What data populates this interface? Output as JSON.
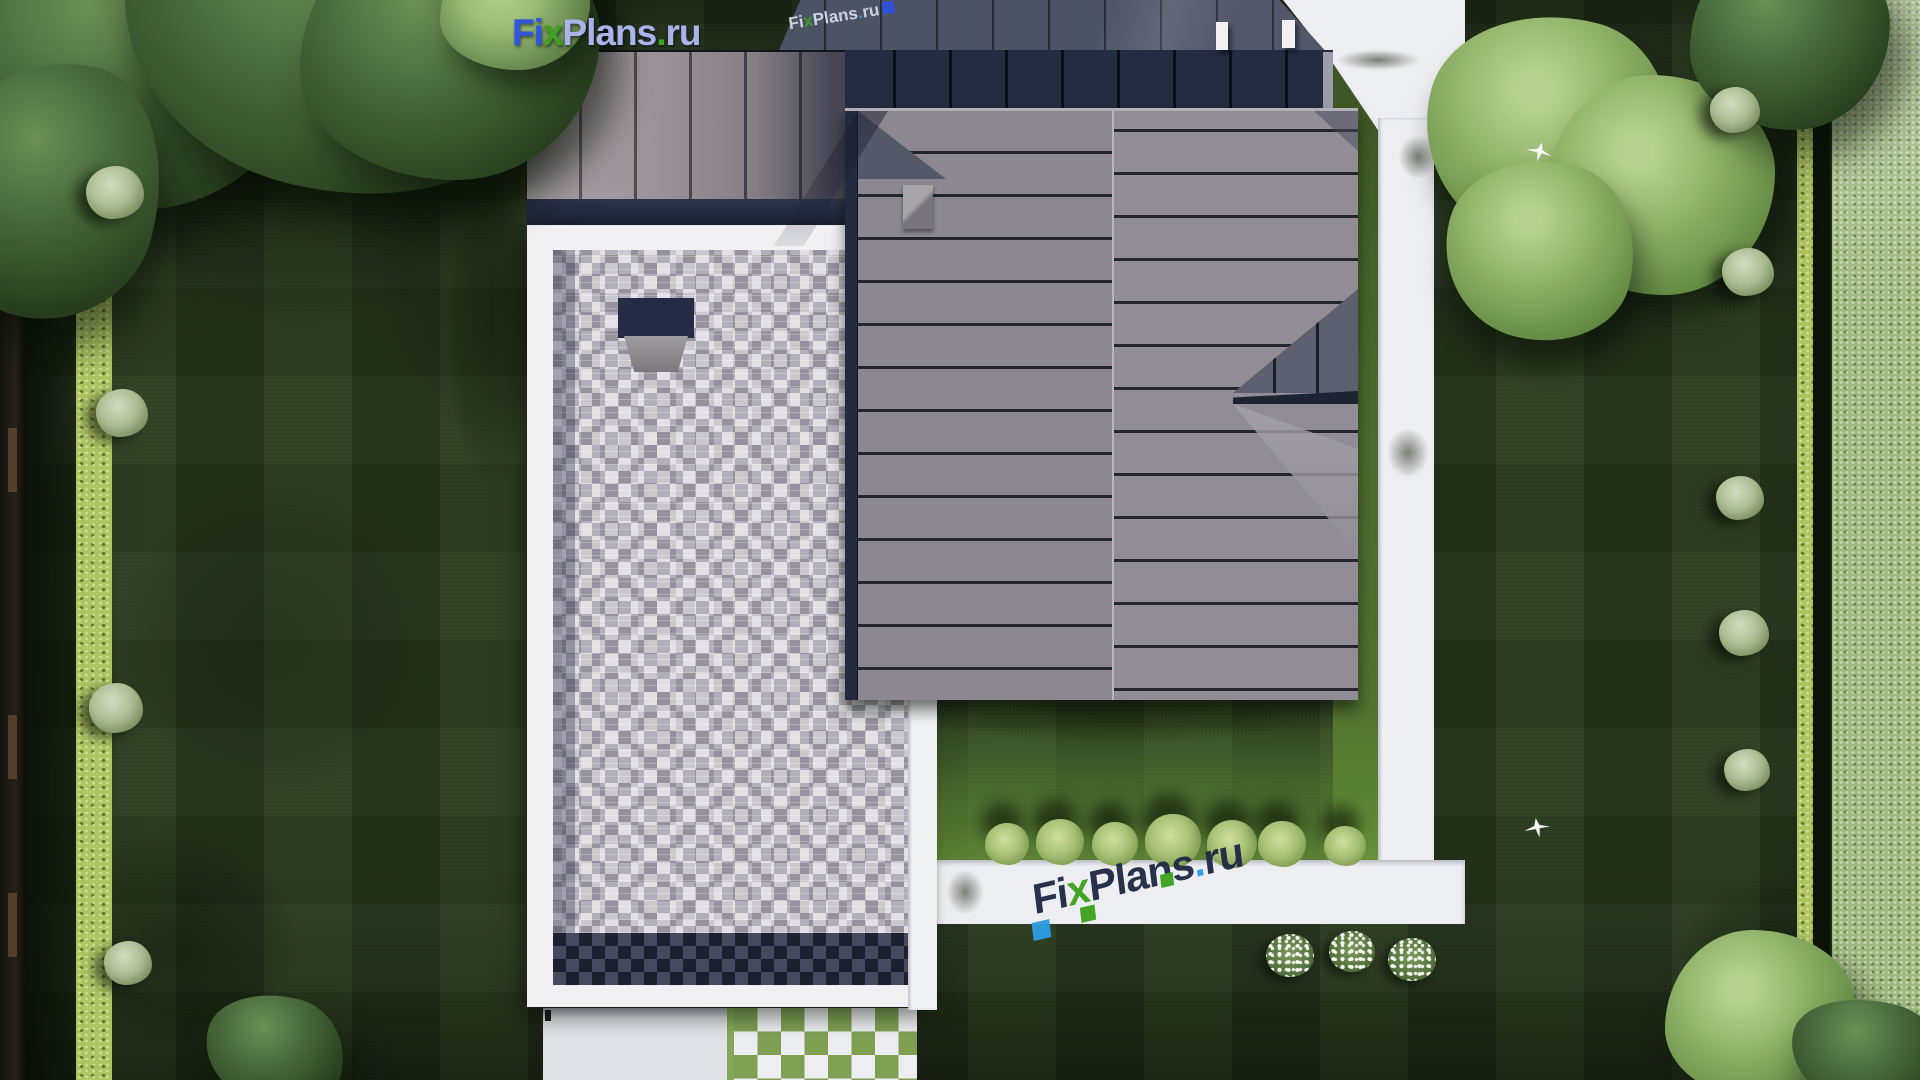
{
  "brand": {
    "fi": "Fi",
    "x": "x",
    "plans": "Plans",
    "dot": ".",
    "ru": "ru"
  },
  "colors": {
    "brand_blue": "#2e54e0",
    "brand_light": "#aab4ea",
    "brand_dark": "#202a44",
    "accent_green": "#3da21e",
    "accent_sky": "#2d9de2",
    "lawn_green": "#2a3b20",
    "hedge_green": "#aec562",
    "neighbor_green": "#9eb97e",
    "path_white": "#edeef2",
    "flat_roof_paver": "#b5b2bb",
    "hip_roof_gray": "#8d8791",
    "seam_navy": "#232c40",
    "slate_roof": "#4c5365",
    "taupe_roof": "#9d9499"
  },
  "scene": {
    "shadows": [
      {
        "x": -20,
        "y": -60,
        "w": 640,
        "h": 440,
        "o": 0.6
      },
      {
        "x": 330,
        "y": 40,
        "w": 330,
        "h": 460,
        "o": 0.4
      },
      {
        "x": 430,
        "y": 120,
        "w": 120,
        "h": 420,
        "o": 0.4
      },
      {
        "x": 16,
        "y": 300,
        "w": 120,
        "h": 780,
        "o": 0.45
      },
      {
        "x": 0,
        "y": 790,
        "w": 340,
        "h": 300,
        "o": 0.5
      },
      {
        "x": 60,
        "y": 430,
        "w": 430,
        "h": 420,
        "o": 0.3
      },
      {
        "x": 1380,
        "y": 140,
        "w": 300,
        "h": 280,
        "o": 0.4
      },
      {
        "x": 1620,
        "y": 60,
        "w": 300,
        "h": 300,
        "o": 0.35
      },
      {
        "x": 1640,
        "y": 840,
        "w": 300,
        "h": 250,
        "o": 0.5
      },
      {
        "x": 870,
        "y": 690,
        "w": 500,
        "h": 60,
        "o": 0.45
      },
      {
        "x": 1336,
        "y": 108,
        "w": 70,
        "h": 580,
        "o": 0.4
      }
    ],
    "path_shadows": [
      {
        "x": 1392,
        "y": 128,
        "w": 52,
        "h": 58
      },
      {
        "x": 1380,
        "y": 420,
        "w": 56,
        "h": 66
      },
      {
        "x": 1322,
        "y": 46,
        "w": 112,
        "h": 28
      },
      {
        "x": 940,
        "y": 862,
        "w": 50,
        "h": 60
      }
    ],
    "trees": [
      {
        "v": "tree-dark",
        "x": -50,
        "y": -90,
        "w": 360,
        "h": 300
      },
      {
        "v": "tree-dark",
        "x": 120,
        "y": -140,
        "w": 430,
        "h": 330
      },
      {
        "v": "tree-dark",
        "x": 300,
        "y": -80,
        "w": 300,
        "h": 260
      },
      {
        "v": "tree-dark",
        "x": -60,
        "y": 60,
        "w": 220,
        "h": 260
      },
      {
        "v": "tree-mid",
        "x": 440,
        "y": -50,
        "w": 150,
        "h": 120
      },
      {
        "v": "tree-bright",
        "x": 1425,
        "y": 15,
        "w": 250,
        "h": 230
      },
      {
        "v": "tree-bright",
        "x": 1545,
        "y": 75,
        "w": 230,
        "h": 220
      },
      {
        "v": "tree-bright",
        "x": 1445,
        "y": 160,
        "w": 190,
        "h": 180
      },
      {
        "v": "tree-dark",
        "x": 1690,
        "y": -60,
        "w": 200,
        "h": 190
      },
      {
        "v": "tree-dark",
        "x": 205,
        "y": 995,
        "w": 140,
        "h": 110
      },
      {
        "v": "tree-bright",
        "x": 1665,
        "y": 930,
        "w": 190,
        "h": 170
      },
      {
        "v": "tree-dark",
        "x": 1790,
        "y": 1000,
        "w": 160,
        "h": 110
      }
    ],
    "bushes": [
      {
        "x": 115,
        "y": 195,
        "d": 58
      },
      {
        "x": 122,
        "y": 415,
        "d": 52
      },
      {
        "x": 116,
        "y": 710,
        "d": 54
      },
      {
        "x": 128,
        "y": 965,
        "d": 48
      },
      {
        "x": 1735,
        "y": 112,
        "d": 50
      },
      {
        "x": 1748,
        "y": 274,
        "d": 52
      },
      {
        "x": 1740,
        "y": 500,
        "d": 48
      },
      {
        "x": 1744,
        "y": 635,
        "d": 50
      },
      {
        "x": 1747,
        "y": 772,
        "d": 46
      }
    ],
    "row_trees": [
      {
        "x": 1007,
        "y": 845,
        "d": 44
      },
      {
        "x": 1060,
        "y": 843,
        "d": 48
      },
      {
        "x": 1115,
        "y": 845,
        "d": 46
      },
      {
        "x": 1173,
        "y": 842,
        "d": 56
      },
      {
        "x": 1232,
        "y": 845,
        "d": 50
      },
      {
        "x": 1282,
        "y": 845,
        "d": 48
      },
      {
        "x": 1345,
        "y": 847,
        "d": 42
      }
    ],
    "flowers": [
      {
        "x": 1290,
        "y": 958,
        "d": 48
      },
      {
        "x": 1352,
        "y": 954,
        "d": 46
      },
      {
        "x": 1412,
        "y": 962,
        "d": 48
      }
    ],
    "birds": [
      {
        "x": 1524,
        "y": 818,
        "rot": -15
      },
      {
        "x": 1526,
        "y": 142,
        "rot": 10
      }
    ],
    "fence_posts": [
      {
        "y": 428
      },
      {
        "y": 715
      },
      {
        "y": 893
      }
    ]
  }
}
